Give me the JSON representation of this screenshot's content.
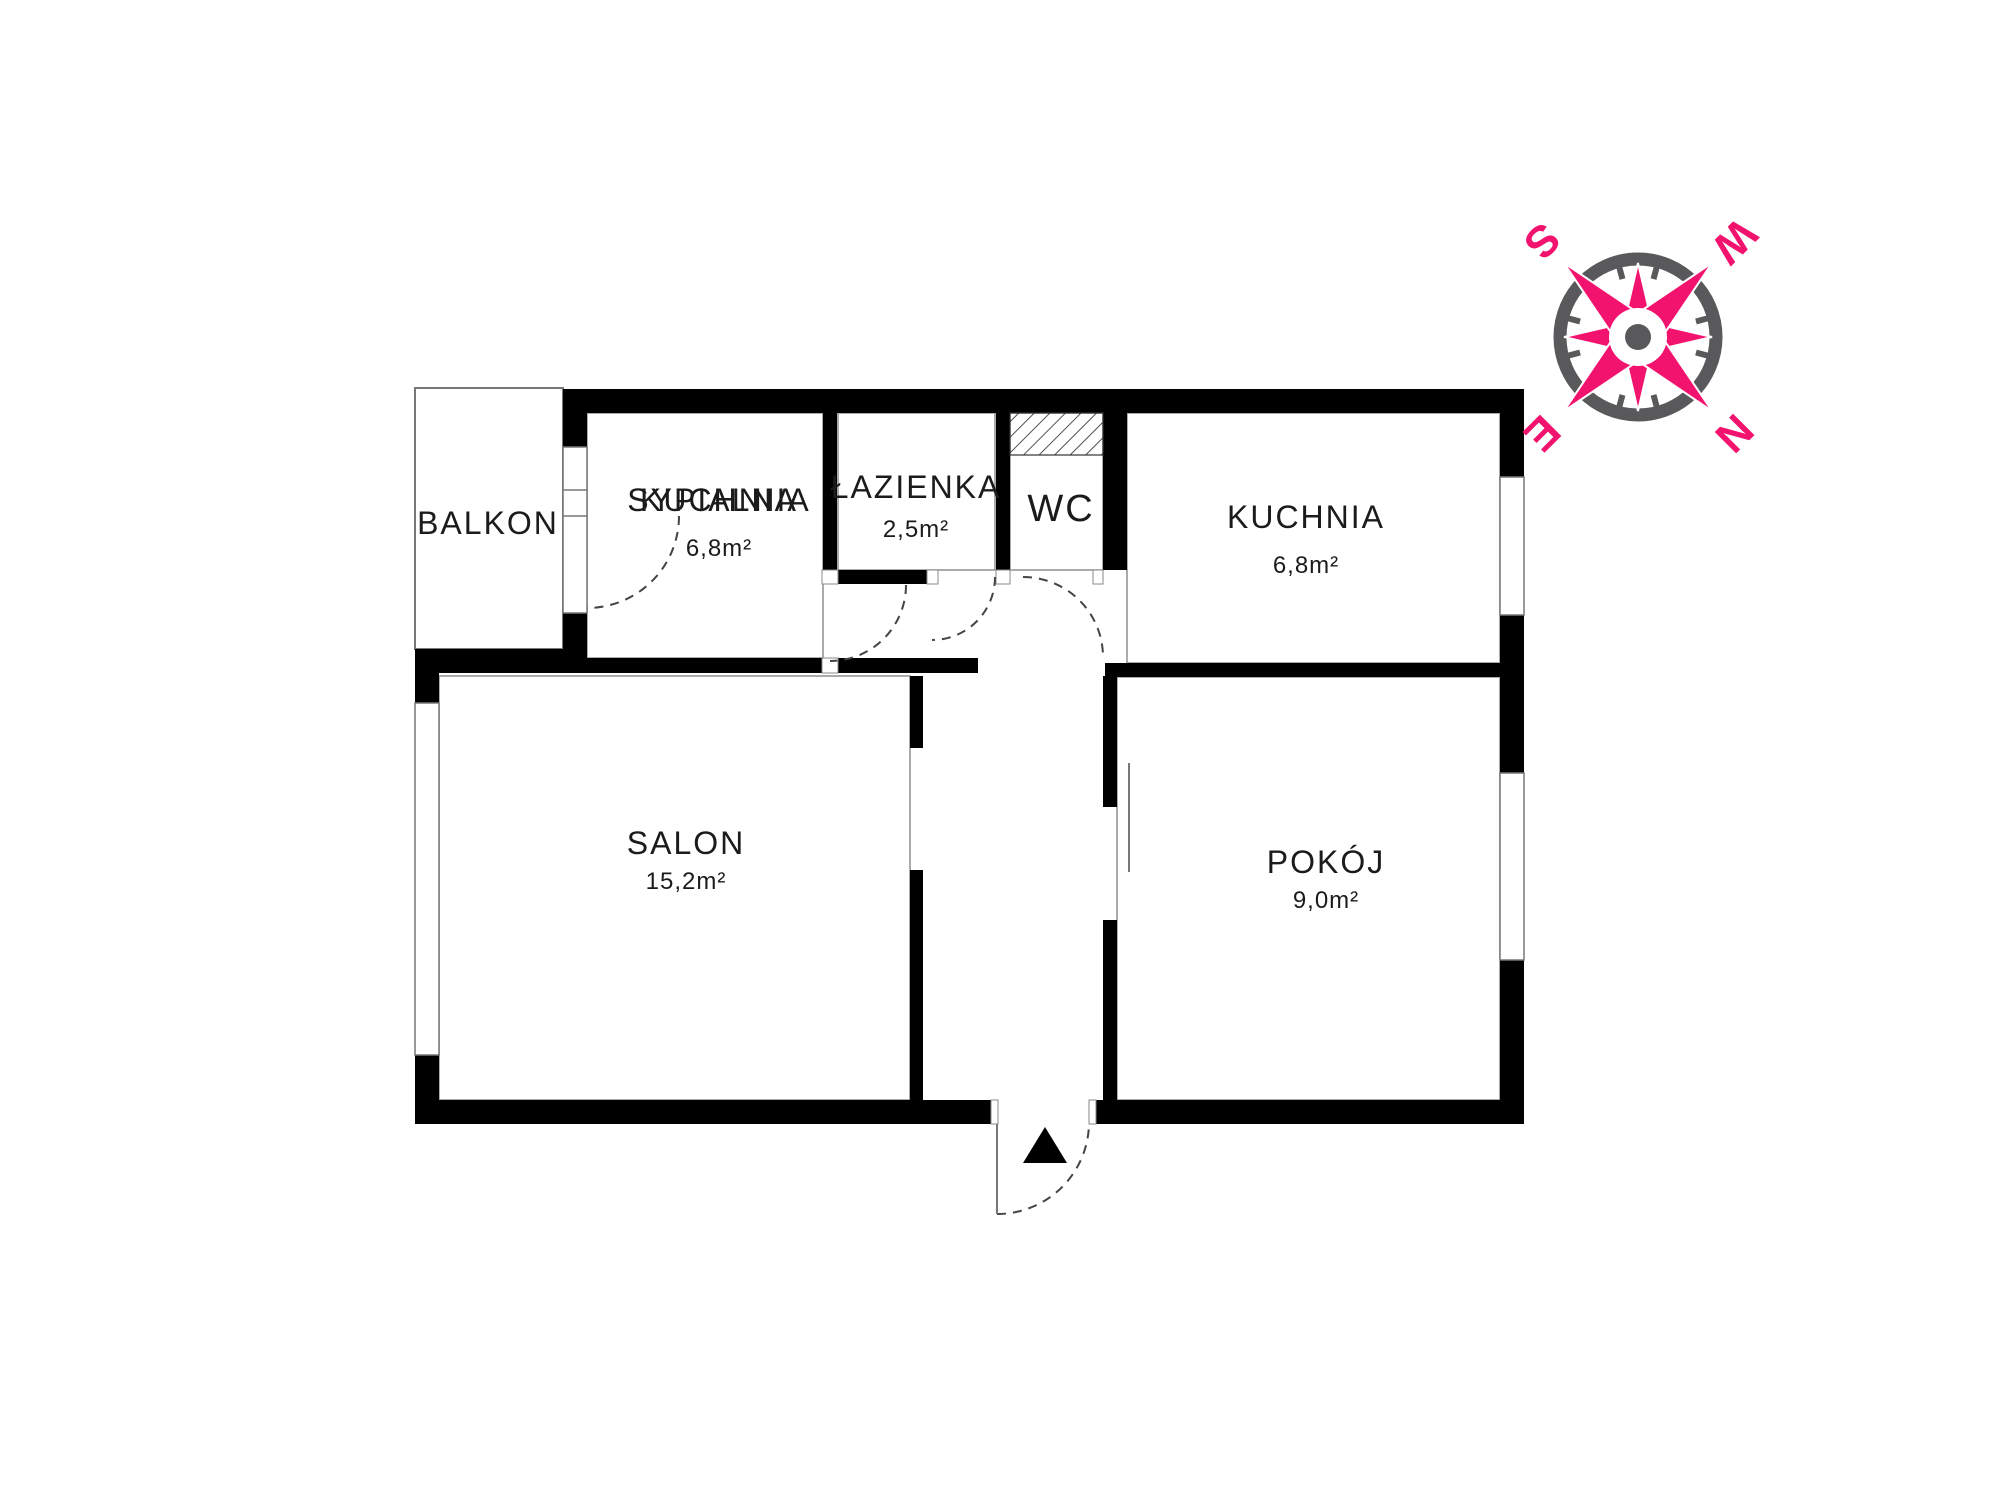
{
  "floorplan": {
    "background": "#ffffff",
    "wall_color": "#000000",
    "text_color": "#1b1b1b",
    "rooms": [
      {
        "id": "balkon",
        "label": "BALKON",
        "area": ""
      },
      {
        "id": "sypialnia",
        "label": "SYPIALNIA",
        "area": "6,8m²",
        "overlapping_label": "KUCHNIA"
      },
      {
        "id": "lazienka",
        "label": "ŁAZIENKA",
        "area": "2,5m²"
      },
      {
        "id": "wc",
        "label": "WC",
        "area": ""
      },
      {
        "id": "kuchnia",
        "label": "KUCHNIA",
        "area": "6,8m²"
      },
      {
        "id": "salon",
        "label": "SALON",
        "area": "15,2m²"
      },
      {
        "id": "pokoj",
        "label": "POKÓJ",
        "area": "9,0m²"
      }
    ],
    "compass": {
      "north": "N",
      "south": "S",
      "east": "E",
      "west": "W",
      "pink": "#F2136F",
      "gray": "#59585A",
      "rotation_deg": 135
    }
  }
}
